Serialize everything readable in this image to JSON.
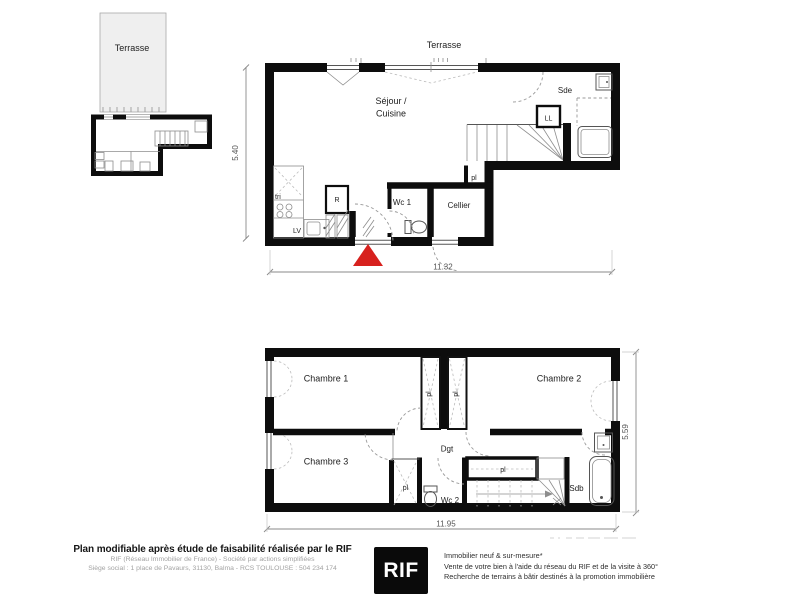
{
  "site_plan": {
    "terrasse": "Terrasse"
  },
  "ground_floor": {
    "terrasse": "Terrasse",
    "sejour_line1": "Séjour /",
    "sejour_line2": "Cuisine",
    "sde": "Sde",
    "ll": "LL",
    "tri": "tri",
    "r": "R",
    "lv": "LV",
    "wc1": "Wc 1",
    "cellier": "Cellier",
    "pl": "pl",
    "dim_width": "11.32",
    "dim_height": "5.40"
  },
  "upper_floor": {
    "chambre1": "Chambre 1",
    "chambre2": "Chambre 2",
    "chambre3": "Chambre 3",
    "dgt": "Dgt",
    "pl": "pl",
    "wc2": "Wc 2",
    "sdb": "Sdb",
    "dim_width": "11.95",
    "dim_height": "5.59"
  },
  "footer": {
    "headline": "Plan modifiable après étude de faisabilité réalisée par le RIF",
    "subline1": "RIF (Réseau Immobilier de France) - Société par actions simplifiées",
    "subline2": "Siège social : 1 place de Pavaurs, 31130, Balma - RCS TOULOUSE : 504 234 174",
    "logo_text": "RIF",
    "tagline1": "Immobilier neuf & sur-mesure*",
    "tagline2": "Vente de votre bien à l'aide du réseau du RIF et de la visite à 360°",
    "tagline3": "Recherche de terrains à bâtir destinés à la promotion immobilière"
  },
  "colors": {
    "wall": "#0d0d0d",
    "entrance_marker": "#d7211e",
    "terrace_fill": "#efefef",
    "dimension_line": "#8a8a8a"
  }
}
